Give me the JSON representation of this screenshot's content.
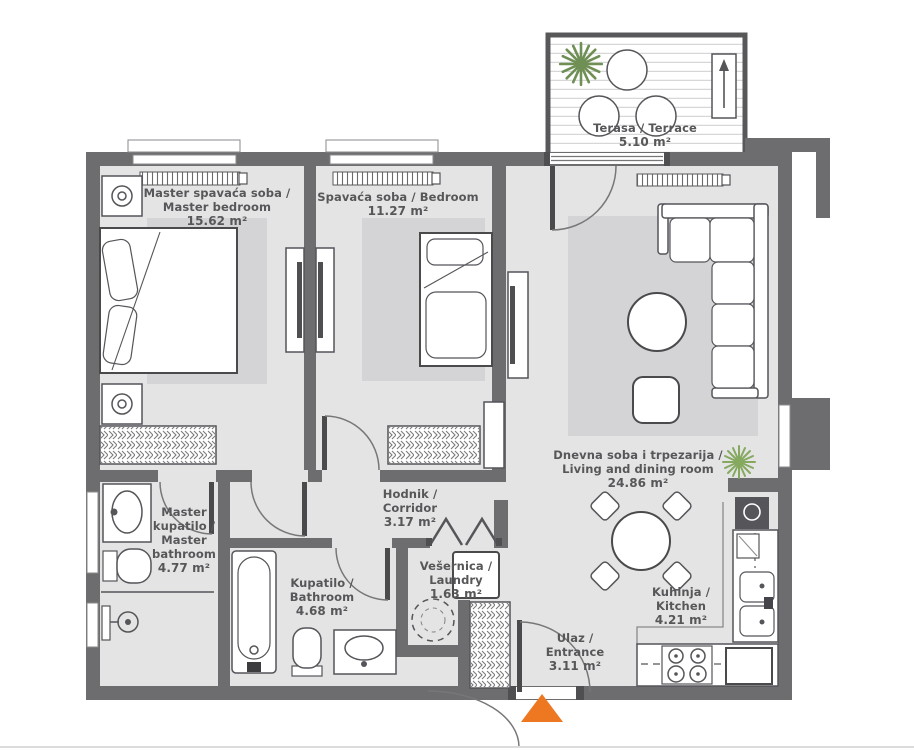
{
  "plan_title": "apartment-floor-plan",
  "colors": {
    "wall": "#6d6d6f",
    "floor": "#e4e4e5",
    "rug": "#d4d4d6",
    "furniture_outline": "#55555a",
    "entrance_arrow": "#ee7722",
    "plant_terrace": "#6f8f55",
    "plant_living": "#84a95f",
    "label_text": "#57575a"
  },
  "icons": {
    "entrance_arrow": "orange ▲ entry marker",
    "plant": "✳ plant top-view burst",
    "planter_arrow": "↑ arrow in terrace planter box",
    "washer_slot": "dashed ◯ appliance position",
    "lamp": "◎ nightstand lamp"
  },
  "rooms": [
    {
      "id": "master-bedroom",
      "lines": [
        "Master spavaća soba /",
        "Master bedroom"
      ],
      "area": "15.62 m²"
    },
    {
      "id": "bedroom",
      "lines": [
        "Spavaća soba / Bedroom"
      ],
      "area": "11.27 m²"
    },
    {
      "id": "terrace",
      "lines": [
        "Terasa / Terrace"
      ],
      "area": "5.10 m²"
    },
    {
      "id": "living",
      "lines": [
        "Dnevna soba i trpezarija /",
        "Living and dining room"
      ],
      "area": "24.86 m²"
    },
    {
      "id": "corridor",
      "lines": [
        "Hodnik /",
        "Corridor"
      ],
      "area": "3.17 m²"
    },
    {
      "id": "master-bathroom",
      "lines": [
        "Master",
        "kupatilo /",
        "Master",
        "bathroom"
      ],
      "area": "4.77 m²"
    },
    {
      "id": "bathroom",
      "lines": [
        "Kupatilo /",
        "Bathroom"
      ],
      "area": "4.68 m²"
    },
    {
      "id": "laundry",
      "lines": [
        "Vešernica /",
        "Laundry"
      ],
      "area": "1.63 m²"
    },
    {
      "id": "entrance",
      "lines": [
        "Ulaz /",
        "Entrance"
      ],
      "area": "3.11 m²"
    },
    {
      "id": "kitchen",
      "lines": [
        "Kuhinja /",
        "Kitchen"
      ],
      "area": "4.21 m²"
    }
  ]
}
